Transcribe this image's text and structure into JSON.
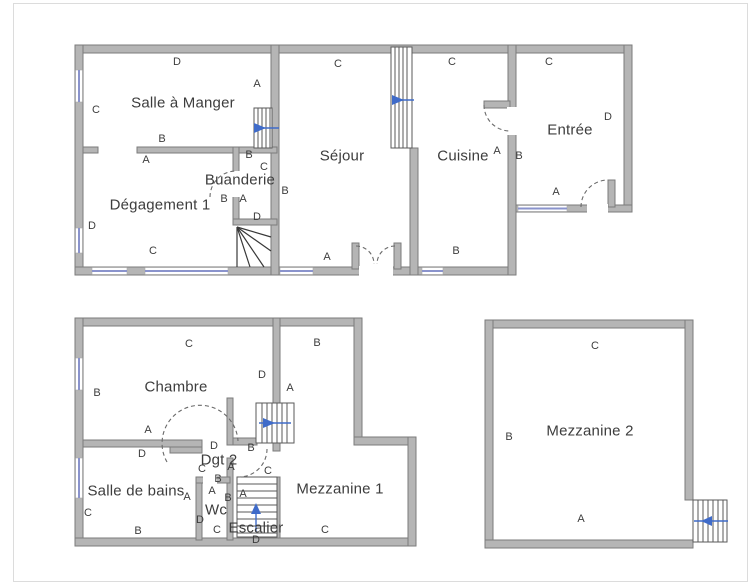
{
  "letters": {
    "a": "A",
    "b": "B",
    "c": "C",
    "d": "D"
  },
  "floors": {
    "ground": {
      "rooms": {
        "salle_a_manger": "Salle à Manger",
        "sejour": "Séjour",
        "cuisine": "Cuisine",
        "entree": "Entrée",
        "buanderie": "Buanderie",
        "degagement": "Dégagement 1"
      }
    },
    "first": {
      "rooms": {
        "chambre": "Chambre",
        "salle_de_bains": "Salle de bains",
        "dgt2": "Dgt 2",
        "wc": "Wc",
        "escalier": "Escalier",
        "mezzanine1": "Mezzanine 1",
        "mezzanine2": "Mezzanine 2"
      }
    }
  },
  "colors": {
    "wall_fill": "#b5b5b5",
    "wall_stroke": "#7b7b7b",
    "window_blue": "#8a93cc",
    "arrow_blue": "#3f6bc9",
    "text": "#3d3d3d",
    "page_border": "#dcdcdc"
  }
}
